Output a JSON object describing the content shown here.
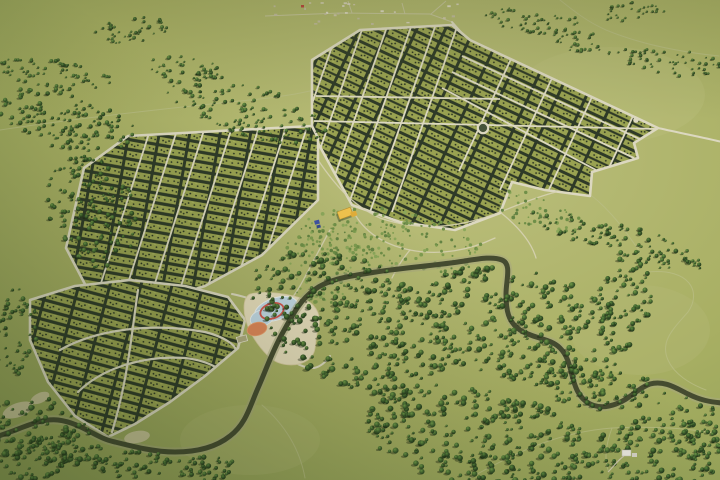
{
  "scene": {
    "kind": "3d-aerial-render",
    "description": "bird's-eye render of a rural plot development with street grids, central park, pond recreation zone, winding river and conifer forests",
    "width": 720,
    "height": 480
  },
  "palette": {
    "field_base": "#a8af63",
    "field_light": "#bcbf7d",
    "field_dark": "#8c9c53",
    "road": "#dcd8c0",
    "road_faint": "#c6c49e",
    "trail": "#b9bd85",
    "plot_dark": "#2e3a28",
    "plot_green": "#99a251",
    "plot_dot": "#232d1e",
    "plot_fleck": "#aeb660",
    "river_water": "#454b30",
    "river_bank": "#a8a87e",
    "bank_sand": "#cfc7a0",
    "sand": "#e7ddbc",
    "pool_blue": "#c3d9e6",
    "pool_edge": "#eef4f6",
    "ring_red": "#d2574e",
    "sport_orange": "#e0875a",
    "court_line": "#e8e4d0",
    "court_fill": "#b0ab80",
    "building_yellow": "#f2c44e",
    "building_yellow_dark": "#e2ae3a",
    "building_blue": "#3f51a3",
    "building_blue_dark": "#35488f",
    "structure_white": "#e9e7df",
    "village_red_roof": "#b8453a",
    "village_roofs": [
      "#d9d3c0",
      "#cfc6ae",
      "#c2baa2",
      "#e2ddcc"
    ],
    "tree_shadow": "rgba(18,26,10,0.38)",
    "shrub_colors": [
      "#7b9a4e",
      "#6b8c46",
      "#8aa65a",
      "#5f7f40"
    ]
  },
  "features": {
    "light_patches": [
      {
        "cx": 430,
        "cy": 155,
        "rx": 42,
        "ry": 13,
        "rot": 10,
        "fill": "#c9c98e",
        "op": 0.4
      },
      {
        "cx": 610,
        "cy": 95,
        "rx": 95,
        "ry": 48,
        "rot": 0,
        "fill": "#bfc182",
        "op": 0.28
      },
      {
        "cx": 160,
        "cy": 210,
        "rx": 60,
        "ry": 30,
        "rot": 0,
        "fill": "#b4ba76",
        "op": 0.3
      },
      {
        "cx": 640,
        "cy": 330,
        "rx": 70,
        "ry": 45,
        "rot": 0,
        "fill": "#b7bb79",
        "op": 0.3
      },
      {
        "cx": 250,
        "cy": 440,
        "rx": 70,
        "ry": 35,
        "rot": 0,
        "fill": "#b2b873",
        "op": 0.35
      }
    ],
    "trails": [
      "M 0,130 C 80,118 170,108 250,100 C 310,95 360,80 420,55 C 435,48 445,38 452,24",
      "M 648,272 C 690,268 702,292 688,312 C 672,330 660,342 668,360 C 674,374 690,384 706,390",
      "M 470,478 C 520,450 560,432 612,428 C 650,426 690,428 718,434",
      "M 612,428 C 606,444 604,458 608,470",
      "M 560,0 C 575,12 588,22 606,30 C 640,44 680,52 719,56",
      "M 592,196 C 610,210 625,230 640,252",
      "M 262,405 C 285,425 300,450 305,478"
    ],
    "village": {
      "box": {
        "x": 263,
        "y": 2,
        "w": 198,
        "h": 26,
        "count": 26
      },
      "red_house": {
        "x": 301,
        "y": 5,
        "w": 3,
        "h": 2.5
      },
      "roads": [
        "M 265,16 L 340,13 L 430,14 L 452,22",
        "M 352,13 L 348,1",
        "M 431,14 L 446,1",
        "M 405,14 L 402,3"
      ]
    },
    "country_roads": [
      "M 452,22 L 468,40",
      "M 658,128 C 685,134 705,138 722,142"
    ],
    "sections": [
      {
        "id": "A",
        "name": "grid-section-northeast",
        "outline": [
          [
            312,
            60
          ],
          [
            360,
            30
          ],
          [
            452,
            25
          ],
          [
            470,
            40
          ],
          [
            658,
            128
          ],
          [
            634,
            143
          ],
          [
            638,
            158
          ],
          [
            592,
            172
          ],
          [
            590,
            196
          ],
          [
            545,
            190
          ],
          [
            512,
            182
          ],
          [
            500,
            213
          ],
          [
            455,
            230
          ],
          [
            400,
            222
          ],
          [
            352,
            205
          ],
          [
            312,
            132
          ]
        ],
        "pattern": {
          "tile": "double",
          "angle": 25
        },
        "streets": [
          [
            314,
            121,
            659,
            129
          ],
          [
            316,
            96,
            500,
            99
          ],
          [
            340,
            24,
            274,
            212
          ],
          [
            364,
            24,
            298,
            212
          ],
          [
            388,
            24,
            322,
            212
          ],
          [
            412,
            24,
            346,
            212
          ],
          [
            436,
            24,
            370,
            212
          ],
          [
            458,
            24,
            392,
            212
          ],
          [
            462,
            56,
            646,
            142
          ],
          [
            452,
            72,
            634,
            158
          ],
          [
            442,
            88,
            596,
            170
          ],
          [
            511,
            59,
            459,
            171
          ],
          [
            552,
            78,
            500,
            190
          ],
          [
            592,
            97,
            540,
            209
          ],
          [
            633,
            116,
            581,
            228
          ]
        ]
      },
      {
        "id": "B",
        "name": "grid-section-west",
        "outline": [
          [
            128,
            136
          ],
          [
            312,
            126
          ],
          [
            318,
            138
          ],
          [
            318,
            200
          ],
          [
            262,
            255
          ],
          [
            205,
            286
          ],
          [
            148,
            304
          ],
          [
            98,
            309
          ],
          [
            66,
            248
          ],
          [
            84,
            168
          ]
        ],
        "pattern": {
          "tile": "single",
          "angle": 10
        },
        "streets": [
          [
            152,
            124,
            93,
            308
          ],
          [
            179,
            124,
            120,
            308
          ],
          [
            206,
            124,
            147,
            308
          ],
          [
            233,
            124,
            174,
            308
          ],
          [
            260,
            124,
            201,
            308
          ],
          [
            287,
            124,
            228,
            308
          ],
          [
            308,
            124,
            249,
            308
          ]
        ]
      },
      {
        "id": "C",
        "name": "grid-section-southwest",
        "outline": [
          [
            30,
            300
          ],
          [
            75,
            286
          ],
          [
            130,
            280
          ],
          [
            185,
            286
          ],
          [
            228,
            297
          ],
          [
            245,
            320
          ],
          [
            238,
            348
          ],
          [
            205,
            376
          ],
          [
            170,
            402
          ],
          [
            135,
            424
          ],
          [
            108,
            437
          ],
          [
            75,
            416
          ],
          [
            48,
            382
          ],
          [
            30,
            340
          ]
        ],
        "pattern": {
          "tile": "single",
          "angle": 15
        },
        "streets": [],
        "curves": [
          "M 60,350 C 95,330 150,322 205,332 C 225,337 235,345 236,350",
          "M 78,392 C 100,370 140,355 185,358 C 205,360 220,368 224,374",
          "M 138,290 C 132,330 128,380 112,432"
        ]
      }
    ],
    "roundabout": {
      "cx": 483,
      "cy": 128,
      "r": 5.2
    },
    "culdesac": {
      "cx": 636,
      "cy": 120,
      "r": 2.8
    },
    "park_paths": [
      "M 318,160 C 335,185 352,205 380,218 C 420,232 460,228 500,212 C 520,204 540,196 556,192",
      "M 352,208 C 360,228 380,244 410,250 C 440,256 470,250 495,238",
      "M 330,230 C 320,248 310,268 300,286 C 293,298 286,306 278,312",
      "M 410,250 C 400,262 396,270 392,278",
      "M 500,212 C 520,228 532,244 536,258"
    ],
    "shrub_blobs": [
      {
        "cx": 395,
        "cy": 240,
        "rx": 95,
        "ry": 30,
        "rot": 8,
        "count": 190
      },
      {
        "cx": 320,
        "cy": 263,
        "rx": 38,
        "ry": 42,
        "rot": 0,
        "count": 90
      },
      {
        "cx": 540,
        "cy": 213,
        "rx": 45,
        "ry": 18,
        "rot": 20,
        "count": 55
      }
    ],
    "beach": {
      "sand_path": "M 250,294 C 266,290 292,294 306,300 C 318,306 322,318 318,330 C 314,344 318,352 308,360 C 296,368 278,366 268,356 C 252,340 244,322 244,308 C 244,300 246,296 250,294 Z",
      "access_road": "M 232,294 C 242,296 250,298 256,302 C 272,312 272,330 280,346 C 288,360 300,368 314,368 C 320,367 326,362 330,356",
      "pool_main": {
        "cx": 276,
        "cy": 309,
        "rx": 22,
        "ry": 11,
        "rot": -18
      },
      "pool_small": {
        "cx": 262,
        "cy": 318,
        "rx": 12,
        "ry": 8,
        "rot": -18
      },
      "red_ring": {
        "cx": 272,
        "cy": 311,
        "rx": 12,
        "ry": 7.5,
        "rot": -18
      },
      "sport_field": {
        "cx": 257,
        "cy": 329,
        "rx": 10,
        "ry": 6.5,
        "rot": -15
      },
      "court": {
        "x": 237,
        "y": 336,
        "w": 10,
        "h": 6,
        "rot": -15
      },
      "structure_dots": [
        [
          301,
          300
        ],
        [
          306,
          302
        ],
        [
          298,
          304
        ]
      ],
      "structure_rect": {
        "x": 303,
        "y": 297,
        "w": 4,
        "h": 2.5
      }
    },
    "river": {
      "path": "M -5,437 C 20,430 38,418 58,420 C 82,423 95,438 115,442 C 135,447 155,452 175,452 C 196,452 215,448 230,436 C 246,424 250,406 258,388 C 266,370 272,352 282,334 C 292,316 300,300 314,290 C 330,278 352,276 376,272 C 402,268 430,266 458,262 C 478,259 492,256 502,260 C 512,264 506,280 506,294 C 506,310 508,322 520,330 C 534,339 550,338 560,348 C 572,360 570,378 578,392 C 586,406 600,410 616,404 C 630,399 638,388 650,384 C 664,380 676,388 688,394 C 700,400 710,402 722,403",
      "bank_patches": [
        {
          "cx": 18,
          "cy": 410,
          "rx": 16,
          "ry": 7,
          "rot": -20
        },
        {
          "cx": 40,
          "cy": 398,
          "rx": 10,
          "ry": 5,
          "rot": -25
        },
        {
          "cx": 137,
          "cy": 437,
          "rx": 13,
          "ry": 6,
          "rot": -10
        }
      ]
    },
    "forest_blobs": [
      {
        "cx": 55,
        "cy": 75,
        "rx": 58,
        "ry": 17,
        "rot": 8,
        "count": 70,
        "s": [
          0.9,
          2.0
        ]
      },
      {
        "cx": 130,
        "cy": 30,
        "rx": 38,
        "ry": 13,
        "rot": -5,
        "count": 40,
        "s": [
          0.9,
          2.0
        ]
      },
      {
        "cx": 68,
        "cy": 122,
        "rx": 72,
        "ry": 30,
        "rot": 15,
        "count": 130,
        "s": [
          1.0,
          2.3
        ]
      },
      {
        "cx": 245,
        "cy": 108,
        "rx": 85,
        "ry": 26,
        "rot": 18,
        "count": 120,
        "s": [
          0.9,
          2.2
        ]
      },
      {
        "cx": 185,
        "cy": 68,
        "rx": 40,
        "ry": 14,
        "rot": 10,
        "count": 45,
        "s": [
          0.9,
          2.0
        ]
      },
      {
        "cx": 532,
        "cy": 20,
        "rx": 48,
        "ry": 14,
        "rot": 5,
        "count": 50,
        "s": [
          0.8,
          1.8
        ]
      },
      {
        "cx": 588,
        "cy": 42,
        "rx": 40,
        "ry": 12,
        "rot": 10,
        "count": 38,
        "s": [
          0.8,
          1.8
        ]
      },
      {
        "cx": 672,
        "cy": 62,
        "rx": 48,
        "ry": 14,
        "rot": 5,
        "count": 55,
        "s": [
          0.8,
          1.8
        ]
      },
      {
        "cx": 630,
        "cy": 12,
        "rx": 35,
        "ry": 10,
        "rot": 0,
        "count": 30,
        "s": [
          0.8,
          1.6
        ]
      },
      {
        "cx": 575,
        "cy": 228,
        "rx": 45,
        "ry": 12,
        "rot": 20,
        "count": 40,
        "s": [
          1.0,
          2.2
        ]
      },
      {
        "cx": 352,
        "cy": 322,
        "rx": 112,
        "ry": 62,
        "rot": 25,
        "count": 330,
        "s": [
          1.2,
          3.0
        ]
      },
      {
        "cx": 520,
        "cy": 325,
        "rx": 105,
        "ry": 58,
        "rot": 15,
        "count": 280,
        "s": [
          1.2,
          3.0
        ]
      },
      {
        "cx": 480,
        "cy": 438,
        "rx": 118,
        "ry": 48,
        "rot": 10,
        "count": 300,
        "s": [
          1.2,
          3.1
        ]
      },
      {
        "cx": 655,
        "cy": 452,
        "rx": 75,
        "ry": 35,
        "rot": 0,
        "count": 130,
        "s": [
          1.2,
          3.0
        ]
      },
      {
        "cx": 625,
        "cy": 300,
        "rx": 26,
        "ry": 52,
        "rot": 8,
        "count": 80,
        "s": [
          1.1,
          2.7
        ]
      },
      {
        "cx": 650,
        "cy": 248,
        "rx": 55,
        "ry": 16,
        "rot": 20,
        "count": 60,
        "s": [
          1.0,
          2.4
        ]
      },
      {
        "cx": 32,
        "cy": 438,
        "rx": 58,
        "ry": 42,
        "rot": 0,
        "count": 120,
        "s": [
          1.2,
          3.0
        ]
      },
      {
        "cx": 62,
        "cy": 450,
        "rx": 40,
        "ry": 16,
        "rot": 0,
        "count": 50,
        "s": [
          1.1,
          2.6
        ]
      },
      {
        "cx": 132,
        "cy": 464,
        "rx": 40,
        "ry": 14,
        "rot": 0,
        "count": 45,
        "s": [
          1.1,
          2.6
        ]
      },
      {
        "cx": 202,
        "cy": 468,
        "rx": 38,
        "ry": 13,
        "rot": 0,
        "count": 40,
        "s": [
          1.1,
          2.6
        ]
      },
      {
        "cx": 92,
        "cy": 212,
        "rx": 44,
        "ry": 58,
        "rot": -20,
        "count": 140,
        "s": [
          1.0,
          2.5
        ]
      },
      {
        "cx": 16,
        "cy": 330,
        "rx": 22,
        "ry": 48,
        "rot": 0,
        "count": 55,
        "s": [
          1.0,
          2.4
        ]
      },
      {
        "cx": 600,
        "cy": 390,
        "rx": 66,
        "ry": 22,
        "rot": 5,
        "count": 70,
        "s": [
          1.1,
          2.7
        ]
      },
      {
        "cx": 692,
        "cy": 428,
        "rx": 26,
        "ry": 36,
        "rot": 0,
        "count": 45,
        "s": [
          1.1,
          2.7
        ]
      }
    ],
    "buildings": {
      "community_yellow": {
        "cx": 346,
        "cy": 213
      },
      "small_blue": {
        "cx": 318,
        "cy": 224
      },
      "white_structure": {
        "x": 622,
        "y": 450,
        "w": 9,
        "h": 6
      },
      "white_structure_path": "M 608,472 C 614,466 618,460 624,456"
    }
  }
}
